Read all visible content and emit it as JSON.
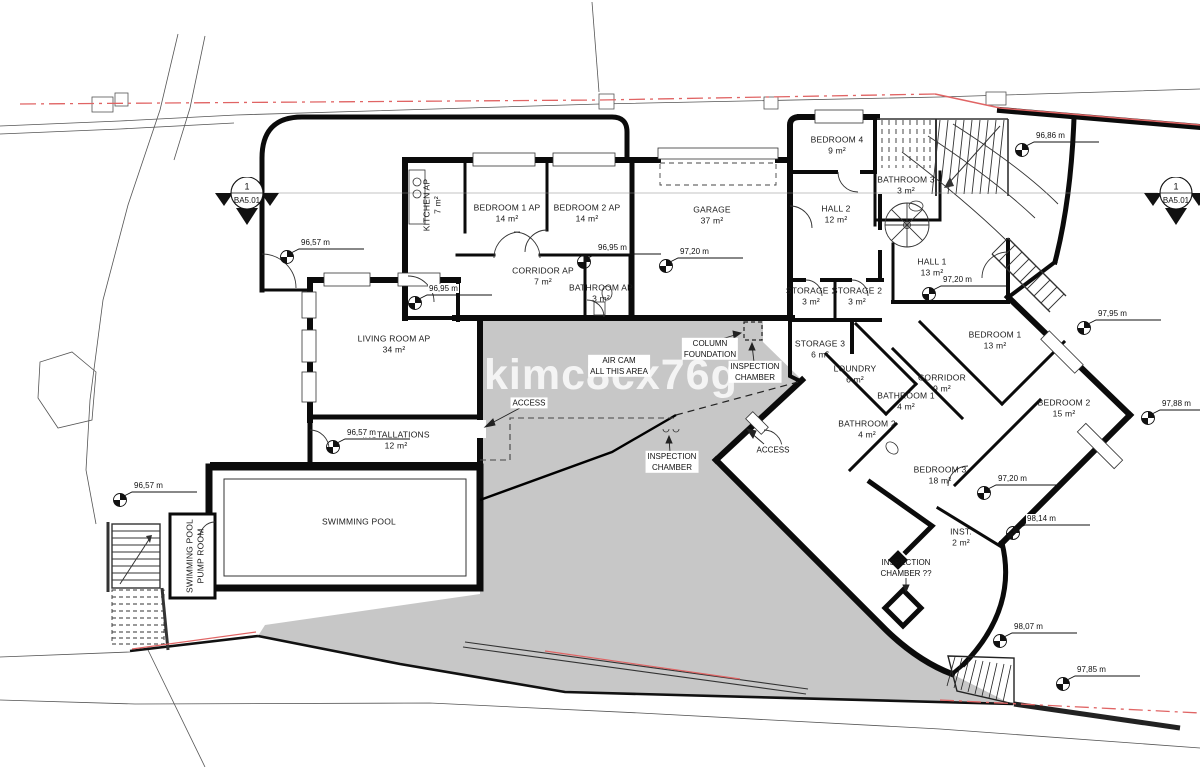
{
  "watermark": "kimc8cx76g",
  "colors": {
    "paper": "#ffffff",
    "wall": "#0b0b0b",
    "terrace_gray": "#c7c7c7",
    "boundary_red": "#e06464"
  },
  "section_markers": [
    {
      "number": "1",
      "code": "BA5.01",
      "x": 247,
      "y": 193
    },
    {
      "number": "1",
      "code": "BA5.01",
      "x": 1176,
      "y": 193
    }
  ],
  "rooms": [
    {
      "name": "KITCHEN AP",
      "area": "7 m²",
      "x": 433,
      "y": 205,
      "rotate": -90
    },
    {
      "name": "BEDROOM 1 AP",
      "area": "14 m²",
      "x": 507,
      "y": 214
    },
    {
      "name": "BEDROOM 2 AP",
      "area": "14 m²",
      "x": 587,
      "y": 214
    },
    {
      "name": "CORRIDOR AP",
      "area": "7 m²",
      "x": 543,
      "y": 277
    },
    {
      "name": "BATHROOM AP",
      "area": "3 m²",
      "x": 601,
      "y": 294
    },
    {
      "name": "GARAGE",
      "area": "37 m²",
      "x": 712,
      "y": 216
    },
    {
      "name": "BEDROOM 4",
      "area": "9 m²",
      "x": 837,
      "y": 146
    },
    {
      "name": "BATHROOM 3",
      "area": "3 m²",
      "x": 906,
      "y": 186
    },
    {
      "name": "HALL 2",
      "area": "12 m²",
      "x": 836,
      "y": 215
    },
    {
      "name": "HALL 1",
      "area": "13 m²",
      "x": 932,
      "y": 268
    },
    {
      "name": "STORAGE 1",
      "area": "3 m²",
      "x": 811,
      "y": 297
    },
    {
      "name": "STORAGE 2",
      "area": "3 m²",
      "x": 857,
      "y": 297
    },
    {
      "name": "STORAGE 3",
      "area": "6 m²",
      "x": 820,
      "y": 350
    },
    {
      "name": "LOUNDRY",
      "area": "6 m²",
      "x": 855,
      "y": 375
    },
    {
      "name": "CORRIDOR",
      "area": "9 m²",
      "x": 942,
      "y": 384
    },
    {
      "name": "BATHROOM 1",
      "area": "4 m²",
      "x": 906,
      "y": 402
    },
    {
      "name": "BATHROOM 2",
      "area": "4 m²",
      "x": 867,
      "y": 430
    },
    {
      "name": "BEDROOM 3",
      "area": "18 m²",
      "x": 940,
      "y": 476
    },
    {
      "name": "BEDROOM 1",
      "area": "13 m²",
      "x": 995,
      "y": 341
    },
    {
      "name": "BEDROOM 2",
      "area": "15 m²",
      "x": 1064,
      "y": 409
    },
    {
      "name": "LIVING ROOM AP",
      "area": "34 m²",
      "x": 394,
      "y": 345
    },
    {
      "name": "INSTALLATIONS",
      "area": "12 m²",
      "x": 396,
      "y": 441
    },
    {
      "name": "SWIMMING POOL",
      "area": "",
      "x": 359,
      "y": 522
    },
    {
      "name": "SWIMMING POOL",
      "name2": "PUMP ROOM",
      "area": "",
      "x": 196,
      "y": 556,
      "rotate": -90
    },
    {
      "name": "INST.",
      "area": "2 m²",
      "x": 961,
      "y": 538
    }
  ],
  "annotations": [
    {
      "lines": [
        "AIR CAM",
        "ALL THIS AREA"
      ],
      "x": 619,
      "y": 366,
      "boxed": true
    },
    {
      "lines": [
        "COLUMN",
        "FOUNDATION"
      ],
      "x": 710,
      "y": 349,
      "boxed": true
    },
    {
      "lines": [
        "INSPECTION",
        "CHAMBER"
      ],
      "x": 755,
      "y": 372,
      "boxed": true
    },
    {
      "lines": [
        "INSPECTION",
        "CHAMBER"
      ],
      "x": 672,
      "y": 462,
      "boxed": true
    },
    {
      "lines": [
        "INSPECTION",
        "CHAMBER ??"
      ],
      "x": 906,
      "y": 568,
      "boxed": false
    },
    {
      "lines": [
        "ACCESS"
      ],
      "x": 529,
      "y": 403,
      "boxed": true
    },
    {
      "lines": [
        "ACCESS"
      ],
      "x": 773,
      "y": 450,
      "boxed": true
    }
  ],
  "elevation_markers": [
    {
      "value": "96,57 m",
      "x": 287,
      "y": 257
    },
    {
      "value": "96,95 m",
      "x": 415,
      "y": 303
    },
    {
      "value": "96,95 m",
      "x": 584,
      "y": 262
    },
    {
      "value": "97,20 m",
      "x": 666,
      "y": 266
    },
    {
      "value": "96,86 m",
      "x": 1022,
      "y": 150
    },
    {
      "value": "97,20 m",
      "x": 929,
      "y": 294
    },
    {
      "value": "97,95 m",
      "x": 1084,
      "y": 328
    },
    {
      "value": "97,88 m",
      "x": 1148,
      "y": 418
    },
    {
      "value": "96,57 m",
      "x": 333,
      "y": 447
    },
    {
      "value": "96,57 m",
      "x": 120,
      "y": 500
    },
    {
      "value": "97,20 m",
      "x": 984,
      "y": 493
    },
    {
      "value": "98,14 m",
      "x": 1013,
      "y": 533
    },
    {
      "value": "98,07 m",
      "x": 1000,
      "y": 641
    },
    {
      "value": "97,85 m",
      "x": 1063,
      "y": 684
    }
  ]
}
